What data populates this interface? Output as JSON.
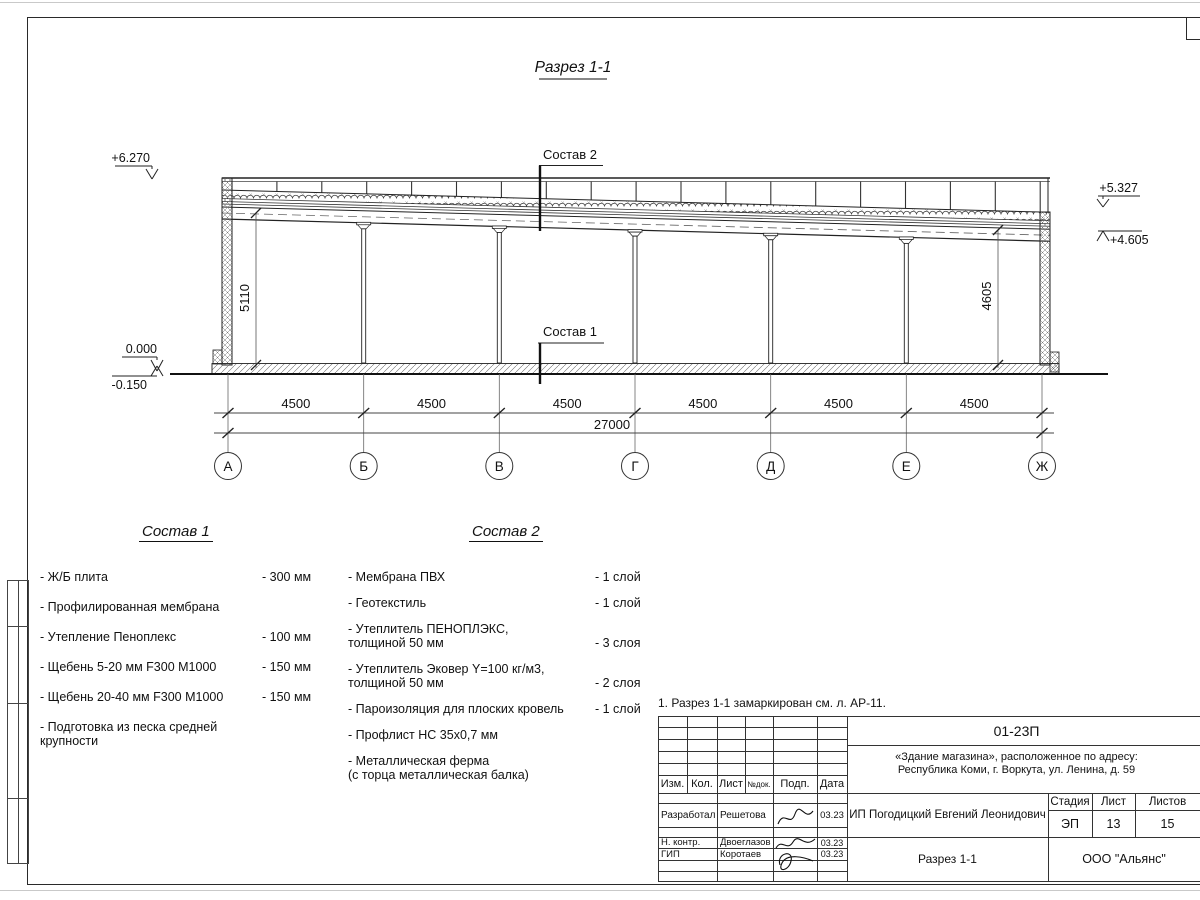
{
  "title": "Разрез 1-1",
  "drawing": {
    "axes": [
      "А",
      "Б",
      "В",
      "Г",
      "Д",
      "Е",
      "Ж"
    ],
    "spans": [
      "4500",
      "4500",
      "4500",
      "4500",
      "4500",
      "4500"
    ],
    "total": "27000",
    "elevations": {
      "left_top": "+6.270",
      "right_top": "+5.327",
      "right_mid": "+4.605",
      "zero": "0.000",
      "minus": "-0.150"
    },
    "heights": {
      "left": "5110",
      "right": "4605"
    },
    "labels": {
      "sostav1": "Состав 1",
      "sostav2": "Состав 2"
    }
  },
  "lists": {
    "sostav1": {
      "title": "Состав 1",
      "items": [
        {
          "name": "- Ж/Б плита",
          "value": "- 300 мм"
        },
        {
          "name": "- Профилированная мембрана",
          "value": ""
        },
        {
          "name": "- Утепление Пеноплекс",
          "value": "- 100 мм"
        },
        {
          "name": "-  Щебень 5-20 мм F300 М1000",
          "value": "- 150 мм"
        },
        {
          "name": "-  Щебень 20-40 мм F300 М1000",
          "value": "- 150 мм"
        },
        {
          "name": "- Подготовка из песка средней\nкрупности",
          "value": ""
        }
      ]
    },
    "sostav2": {
      "title": "Состав 2",
      "items": [
        {
          "name": "- Мембрана ПВХ",
          "value": "- 1 слой"
        },
        {
          "name": "- Геотекстиль",
          "value": "- 1 слой"
        },
        {
          "name": "- Утеплитель ПЕНОПЛЭКС,\nтолщиной 50 мм",
          "value": "- 3 слоя"
        },
        {
          "name": "- Утеплитель Эковер Y=100 кг/м3,\nтолщиной 50 мм",
          "value": "- 2 слоя"
        },
        {
          "name": "- Пароизоляция для плоских кровель",
          "value": "- 1 слой"
        },
        {
          "name": "- Профлист НС 35х0,7 мм",
          "value": ""
        },
        {
          "name": "- Металлическая ферма\n(с торца металлическая балка)",
          "value": ""
        }
      ]
    }
  },
  "note": "1. Разрез 1-1 замаркирован см. л. АР-11.",
  "titleblock": {
    "doc_number": "01-23П",
    "object_line1": "«Здание магазина», расположенное по адресу:",
    "object_line2": "Республика Коми, г. Воркута, ул. Ленина, д. 59",
    "header": [
      "Изм.",
      "Кол.",
      "Лист",
      "№док.",
      "Подп.",
      "Дата"
    ],
    "rows": [
      {
        "role": "Разработал",
        "name": "Решетова",
        "date": "03.23"
      },
      {
        "role": "Н. контр.",
        "name": "Двоеглазов",
        "date": "03.23"
      },
      {
        "role": "ГИП",
        "name": "Коротаев",
        "date": "03.23"
      }
    ],
    "client": "ИП Погодицкий Евгений Леонидович",
    "stage_label": "Стадия",
    "sheet_label": "Лист",
    "sheets_label": "Листов",
    "stage": "ЭП",
    "sheet": "13",
    "sheets": "15",
    "section_name": "Разрез 1-1",
    "company": "ООО \"Альянс\""
  }
}
